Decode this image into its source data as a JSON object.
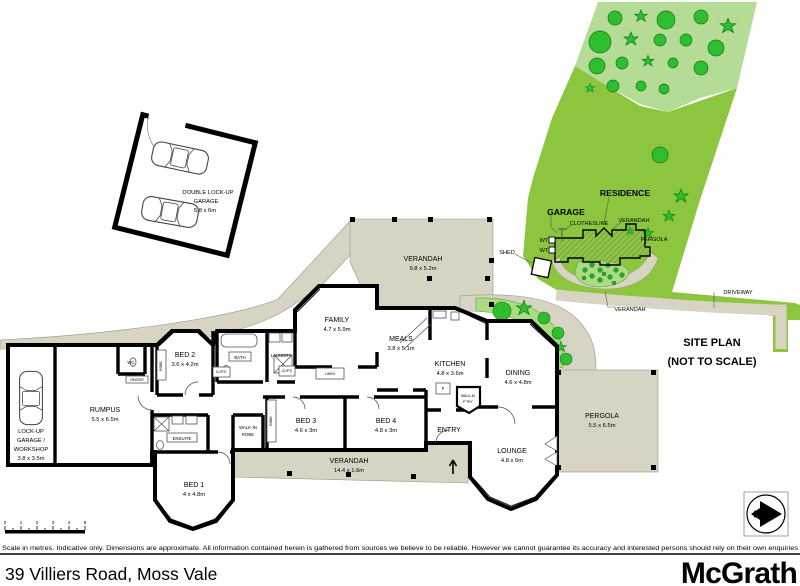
{
  "meta": {
    "address": "39 Villiers Road, Moss Vale",
    "brand": "McGrath",
    "disclaimer": "Scale in metres. Indicative only. Dimensions are approximate. All information contained herein is gathered from sources we believe to be reliable. However we cannot guarantee its accuracy and interested persons should rely on their own enquiries",
    "compass_letter": "N"
  },
  "scale_bar": {
    "ticks": [
      "0",
      "1",
      "2",
      "3",
      "4",
      "5"
    ]
  },
  "detached_garage": {
    "line1": "DOUBLE LOCK-UP",
    "line2": "GARAGE",
    "dims": "5.8 x 6m"
  },
  "site_plan": {
    "title": "SITE PLAN",
    "subtitle": "(NOT TO SCALE)",
    "residence": "RESIDENCE",
    "garage": "GARAGE",
    "clothesline": "CLOTHESLINE",
    "verandah_top": "VERANDAH",
    "verandah_bottom": "VERANDAH",
    "pergola": "PERGOLA",
    "shed": "SHED",
    "wt1": "WT",
    "wt2": "WT",
    "driveway": "DRIVEWAY"
  },
  "rooms": {
    "verandah_top": {
      "name": "VERANDAH",
      "dims": "9.8 x 5.2m"
    },
    "family": {
      "name": "FAMILY",
      "dims": "4.7 x 5.9m"
    },
    "meals": {
      "name": "MEALS",
      "dims": "3.8 x 5.1m"
    },
    "kitchen": {
      "name": "KITCHEN",
      "dims": "4.8 x 3.6m"
    },
    "dining": {
      "name": "DINING",
      "dims": "4.6 x 4.8m"
    },
    "lounge": {
      "name": "LOUNGE",
      "dims": "4.8 x 6m"
    },
    "pergola": {
      "name": "PERGOLA",
      "dims": "5.5 x 6.5m"
    },
    "entry": {
      "name": "ENTRY"
    },
    "rumpus": {
      "name": "RUMPUS",
      "dims": "5.5 x 6.5m"
    },
    "bed1": {
      "name": "BED 1",
      "dims": "4 x 4.8m"
    },
    "bed2": {
      "name": "BED 2",
      "dims": "3.6 x 4.2m"
    },
    "bed3": {
      "name": "BED 3",
      "dims": "4.6 x 3m"
    },
    "bed4": {
      "name": "BED 4",
      "dims": "4.8 x 3m"
    },
    "verandah_bottom": {
      "name": "VERANDAH",
      "dims": "14.4 x 1.6m"
    },
    "lockup_garage": {
      "line1": "LOCK-UP",
      "line2": "GARAGE /",
      "line3": "WORKSHOP",
      "dims": "3.8 x 3.5m"
    }
  },
  "minor_labels": {
    "wc": "WC",
    "heater": "HEATER",
    "bath": "BATH",
    "laundry": "LAUNDRY",
    "ensuite": "ENSUITE",
    "walkin_robe_1": "WALK-IN",
    "walkin_robe_2": "ROBE",
    "walkin_pantry_1": "WALK-IN",
    "walkin_pantry_2": "P'TRY",
    "linen": "LINEN",
    "robe_bed2": "ROBE",
    "robe_bed3": "ROBE",
    "cupd1": "CUP'D",
    "cupd2": "CUP'D",
    "fridge": "F"
  },
  "colors": {
    "verandah_beige": "#d8d4c3",
    "wall_black": "#000000",
    "lawn_green": "#8cc63f",
    "treed_green": "#b5dc96",
    "tree_green": "#2fbe2f",
    "garden_green": "#acdc82"
  }
}
